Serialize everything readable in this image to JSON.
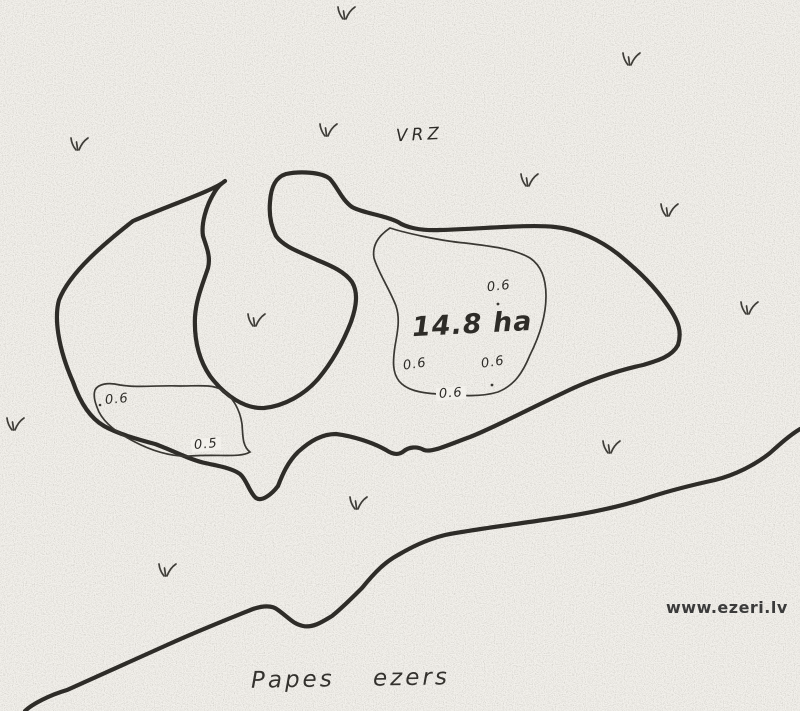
{
  "map": {
    "zone_label": "VRZ",
    "area_label": "14.8 ha",
    "lake_name": "Papes ezers",
    "watermark": "www.ezeri.lv",
    "depth_labels": [
      {
        "value": "0.6"
      },
      {
        "value": "0.6"
      },
      {
        "value": "0.6"
      },
      {
        "value": "0.6"
      },
      {
        "value": "0.6"
      },
      {
        "value": "0.5"
      }
    ],
    "vegetation_marks": {
      "symbol": "grass-tuft",
      "count": 12
    }
  },
  "colors": {
    "paper": "#f3f1ec",
    "ink": "#2e2c28",
    "contour_thin": "#3a3833",
    "watermark_text": "#3b3b3b"
  }
}
